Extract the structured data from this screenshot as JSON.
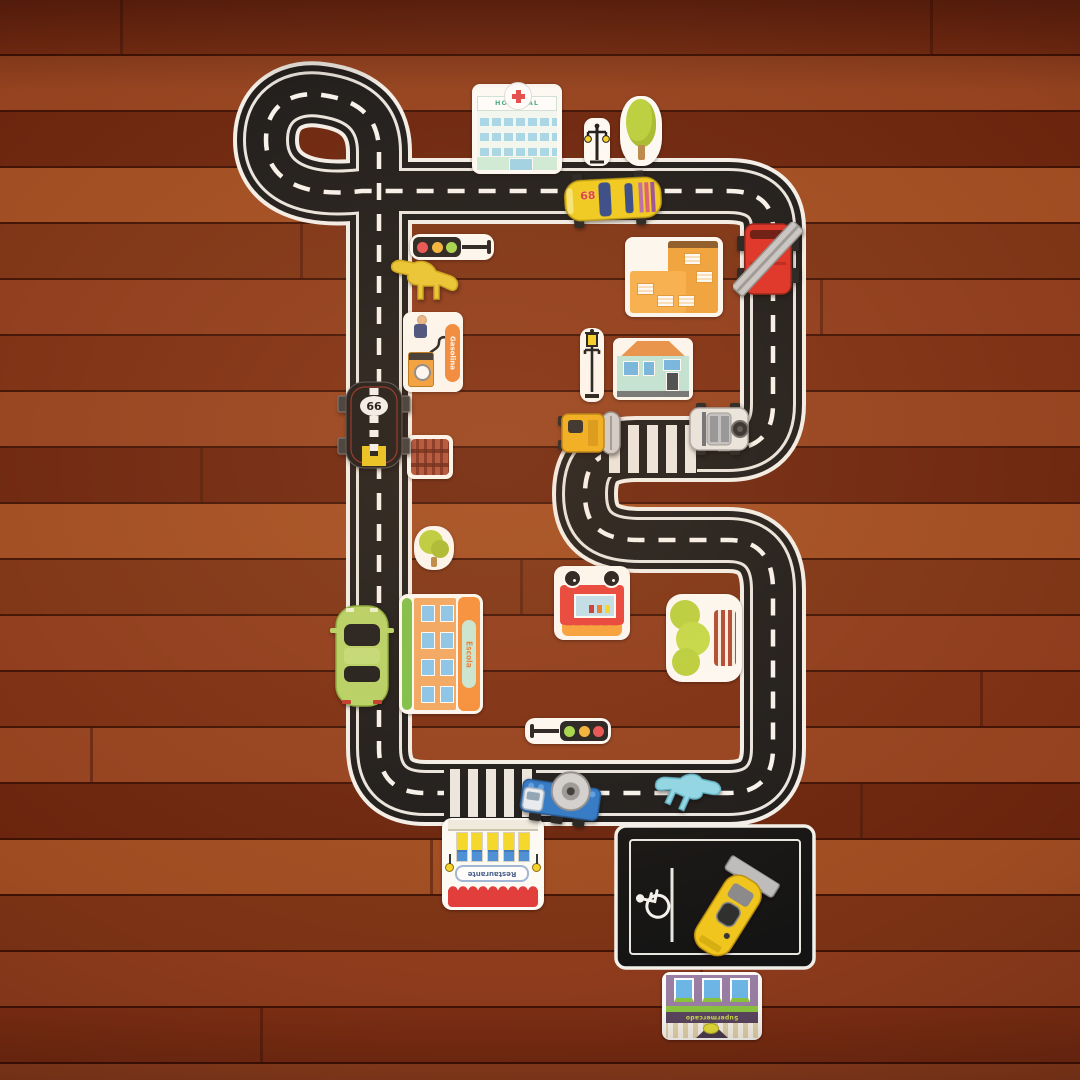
{
  "scene": {
    "description": "Photograph of a toy city road-track playset laid out on a reddish-brown hardwood floor, decorated with cardboard building stickers and toy vehicles and dinosaurs",
    "floor_material": "wood planks",
    "track_features": [
      "loop turnaround",
      "s-curve",
      "crossroads junction",
      "two zebra crosswalks",
      "parking lot with accessible space"
    ]
  },
  "labels": {
    "hospital": "HOSPITAL",
    "gas_station": "Gasolina",
    "school": "Escola",
    "restaurant": "Restaurante",
    "supermarket": "Supermercado",
    "black_race_car_number": "66",
    "yellow_race_car_number": "68"
  },
  "colors": {
    "floor_base": "#8a3a1a",
    "road_surface": "#1b1b1b",
    "road_markings": "#f3f1ec",
    "sticker_border": "#fdfcf8",
    "race_car_yellow": "#f0cd1f",
    "race_car_black": "#181818",
    "car_green": "#b6d468",
    "fire_truck_red": "#dd3127",
    "mixer_blue": "#2e79c9",
    "roller_yellow": "#f0b01c",
    "gas_sign_orange": "#f08a3c",
    "school_orange": "#f2a963",
    "awning_red": "#e03b3b",
    "foliage_green": "#b9d23f",
    "traffic_red": "#e85353",
    "traffic_yellow": "#f2b53c",
    "traffic_green": "#a4d94e"
  },
  "items": [
    {
      "name": "hospital-sticker",
      "kind": "building sticker",
      "label": "HOSPITAL"
    },
    {
      "name": "double-street-lamp-sticker",
      "kind": "street furniture sticker"
    },
    {
      "name": "tree-sticker",
      "kind": "nature sticker"
    },
    {
      "name": "yellow-race-car",
      "kind": "toy vehicle",
      "number": "68"
    },
    {
      "name": "fire-truck",
      "kind": "toy vehicle"
    },
    {
      "name": "orange-apartment-sticker",
      "kind": "building sticker"
    },
    {
      "name": "traffic-light-sticker-upper",
      "kind": "street furniture sticker"
    },
    {
      "name": "yellow-dinosaur",
      "kind": "toy animal"
    },
    {
      "name": "gas-station-sticker",
      "kind": "building sticker",
      "label": "Gasolina"
    },
    {
      "name": "black-race-car",
      "kind": "toy vehicle",
      "number": "66"
    },
    {
      "name": "bench-sticker",
      "kind": "street furniture sticker"
    },
    {
      "name": "street-lamp-sticker",
      "kind": "street furniture sticker"
    },
    {
      "name": "house-sticker",
      "kind": "building sticker"
    },
    {
      "name": "road-roller",
      "kind": "toy vehicle"
    },
    {
      "name": "white-jeep",
      "kind": "toy vehicle"
    },
    {
      "name": "small-bush-sticker",
      "kind": "nature sticker"
    },
    {
      "name": "school-sticker",
      "kind": "building sticker",
      "label": "Escola"
    },
    {
      "name": "green-car",
      "kind": "toy vehicle"
    },
    {
      "name": "food-cart-sticker",
      "kind": "building sticker"
    },
    {
      "name": "sideways-tree-sticker",
      "kind": "nature sticker"
    },
    {
      "name": "traffic-light-sticker-lower",
      "kind": "street furniture sticker"
    },
    {
      "name": "mixer-truck",
      "kind": "toy vehicle"
    },
    {
      "name": "blue-dinosaur",
      "kind": "toy animal"
    },
    {
      "name": "restaurant-sticker",
      "kind": "building sticker",
      "label": "Restaurante"
    },
    {
      "name": "spoiler-race-car",
      "kind": "toy vehicle"
    },
    {
      "name": "supermarket-sticker",
      "kind": "building sticker",
      "label": "Supermercado"
    }
  ]
}
